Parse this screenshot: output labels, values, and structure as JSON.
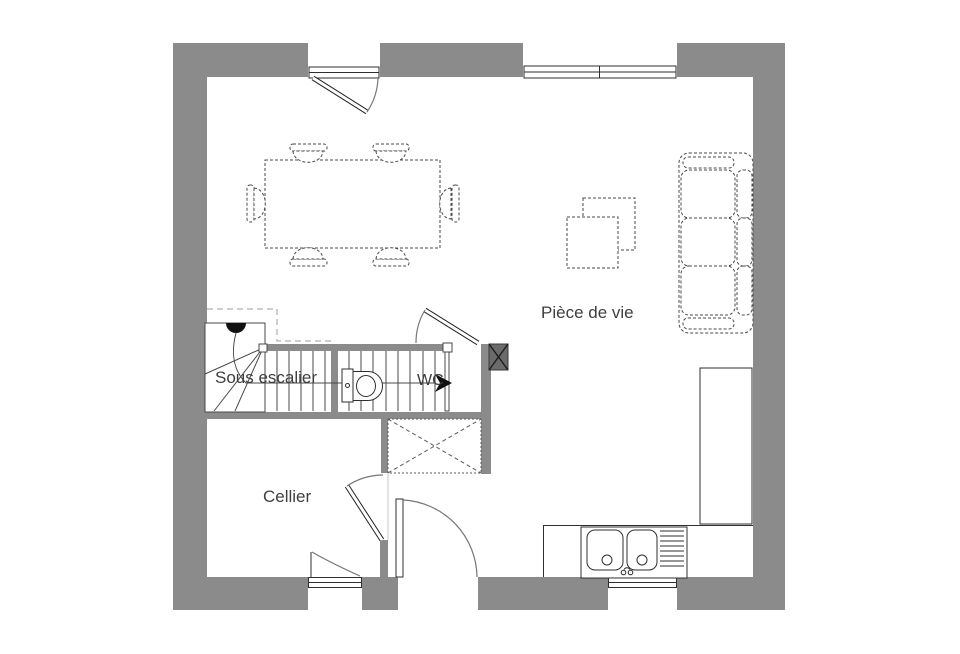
{
  "plan": {
    "rooms": {
      "living_room": "Pièce de vie",
      "under_stairs": "Sous escalier",
      "wc": "WC",
      "cellar": "Cellier"
    }
  },
  "colors": {
    "background": "#ffffff",
    "wall": "#8b8b8b",
    "post": "#6b6b6b",
    "line": "#2f2f2f",
    "stair_line": "#4a4a4a",
    "furniture_line": "#4a4a4a",
    "door_arc": "#777777",
    "overhang_dash": "#bdbdbd",
    "text": "#3f3f3f"
  },
  "fixtures": [
    "dining-table",
    "dining-chair",
    "sofa",
    "coffee-table",
    "winder-staircase",
    "toilet",
    "kitchen-sink",
    "kitchen-counter",
    "tall-cabinet",
    "duct-box",
    "technical-post",
    "garden-door",
    "entry-door",
    "wc-door",
    "cellar-door",
    "top-window",
    "cellar-window",
    "kitchen-window"
  ]
}
